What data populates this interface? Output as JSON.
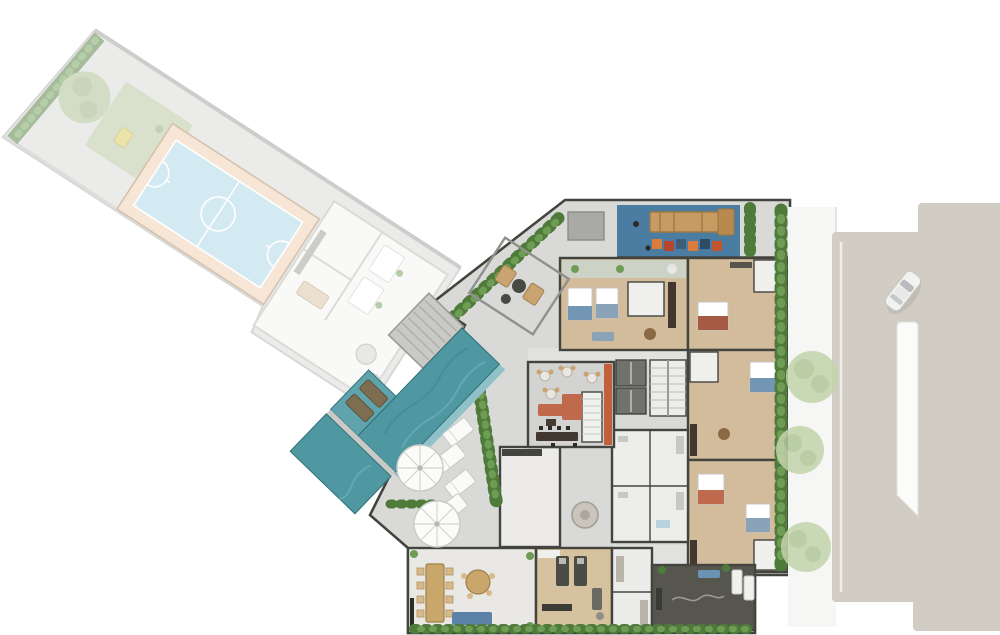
{
  "meta": {
    "kind": "architectural-floorplan-top-view-render",
    "floors_shown": 1,
    "has_visible_text": false
  },
  "palette": {
    "bg": "#ffffff",
    "strip-base": "#d8d8d6",
    "strip-wall": "#9c9c98",
    "court-blue": "#a9d7e9",
    "court-border": "#f1cfae",
    "court-rim": "#a9885f",
    "grass": "#b5c49a",
    "hedge-dark": "#4e7a3a",
    "hedge-light": "#6f9c55",
    "tree-faded": "#a9bd8e",
    "tree-faded2": "#94ab77",
    "pool": "#4f98a2",
    "pool-deep": "#3f8791",
    "pool-edge": "#8ec2c8",
    "pool-shelf": "#5fa3ac",
    "pool-lounger": "#7d6d51",
    "deck": "#c9c9c6",
    "deck-line": "#aeaeaa",
    "plaza": "#d9d9d7",
    "wall": "#44443f",
    "wood": "#d2bc9c",
    "wood-light": "#dfcdb0",
    "floor-white": "#efefed",
    "corridor": "#e1e1df",
    "terracotta": "#bf6a4d",
    "orange-wall": "#c2603b",
    "bar-dark": "#42382f",
    "blue-furn": "#7396b4",
    "blue-soft": "#8ba3b8",
    "red-blanket": "#a65a43",
    "street": "#d2cdc4",
    "sidewalk": "#f6f6f5",
    "median": "#fbfbfa",
    "street-tree": "#c2d4ab",
    "street-tree2": "#b0c697",
    "playground-blue": "#4b7da3",
    "play-wood": "#c89b62",
    "zen-dark": "#56564f",
    "equip-dark": "#4c4c46",
    "chair-tan": "#c9a471",
    "table-wood": "#c9a76b",
    "white-furn": "#fafaf9",
    "balcony-green": "#ccd2c6",
    "elevator": "#72726c",
    "storage-gray": "#a9a9a5",
    "car-body": "#f2f2f0",
    "car-glass": "#b9bcbe"
  },
  "scene": {
    "faded_amenity_strip": [
      "hedge-end",
      "tree",
      "grass-playground",
      "futsal-court",
      "cabana-rooms",
      "parasol-tables"
    ],
    "vivid_amenities": [
      "wood-deck-steps",
      "lap-pool",
      "sun-shelf",
      "kids-playground",
      "pergola",
      "lounge",
      "co-working",
      "gym",
      "spa",
      "zen-patio",
      "terrace"
    ],
    "building_units": [
      "unit-a",
      "unit-b",
      "unit-c",
      "unit-d",
      "elevator-core",
      "stair-core",
      "bath-block",
      "laundry-room"
    ],
    "street_side": [
      "sidewalk",
      "street",
      "median-island",
      "car"
    ]
  },
  "objects": {
    "terrace_sun_loungers": 4,
    "pool_shelf_loungers": 2,
    "terrace_umbrellas": 2,
    "pergola_chairs": 2,
    "street_trees": 3,
    "coworking_chairs": 8,
    "treadmills": 2,
    "elevators": 2,
    "bistro_tables": 4,
    "playground_tiles": 6
  }
}
